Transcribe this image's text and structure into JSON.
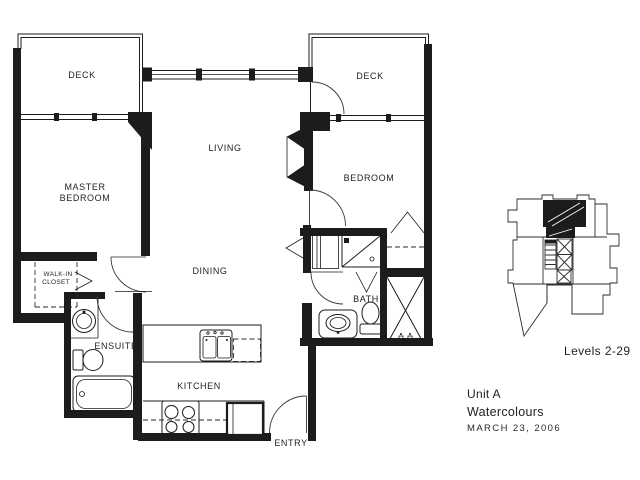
{
  "document": {
    "type": "architectural-floor-plan",
    "background_color": "#ffffff",
    "line_color": "#1c1c1c"
  },
  "plan": {
    "rooms": {
      "deck_left": "DECK",
      "deck_right": "DECK",
      "living": "LIVING",
      "master_bedroom_line1": "MASTER",
      "master_bedroom_line2": "BEDROOM",
      "bedroom": "BEDROOM",
      "dining": "DINING",
      "kitchen": "KITCHEN",
      "bath": "BATH",
      "ensuite": "ENSUITE",
      "walk_in_closet_line1": "WALK-IN",
      "walk_in_closet_line2": "CLOSET",
      "entry": "ENTRY"
    },
    "fixtures": [
      "double-kitchen-sink",
      "dishwasher",
      "range",
      "refrigerator",
      "shower",
      "bath-vanity-sink",
      "toilet",
      "washer-dryer-closet",
      "bedroom-closet-rod",
      "ensuite-vanity-sink",
      "ensuite-toilet",
      "bathtub",
      "fireplace"
    ]
  },
  "key_plan": {
    "caption": "Levels 2-29",
    "highlighted_unit_color": "#000000"
  },
  "title_block": {
    "unit": "Unit A",
    "project": "Watercolours",
    "date": "MARCH 23, 2006"
  }
}
